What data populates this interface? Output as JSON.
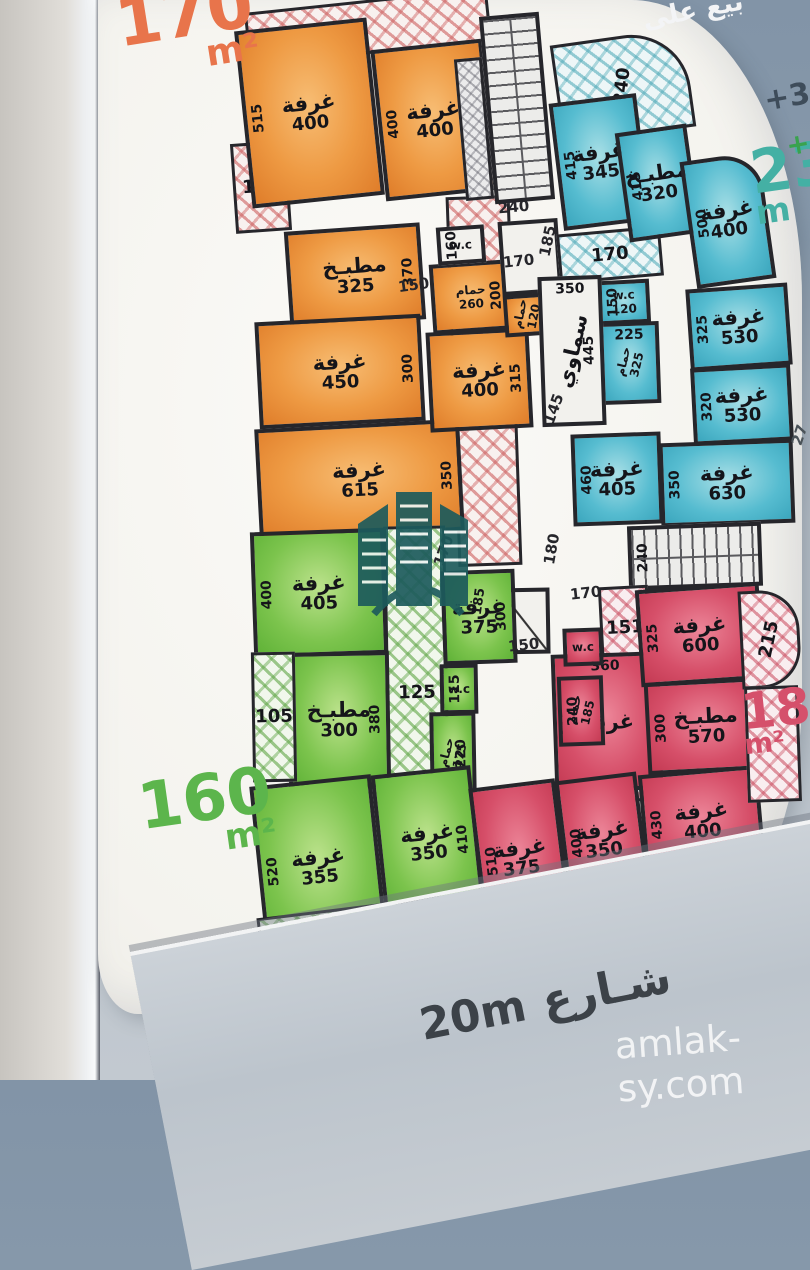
{
  "photo": {
    "captions": {
      "top_right_partial": "بيع على",
      "street": "شـارع 20m",
      "watermark": "amlak-sy.com"
    },
    "area_tags": {
      "unit_170": {
        "value": "170",
        "unit": "m²"
      },
      "unit_230": {
        "value": "230",
        "unit": "m"
      },
      "unit_160": {
        "value": "160",
        "unit": "m²"
      },
      "unit_185": {
        "value": "185",
        "unit": "m²"
      },
      "floor_35": "+35",
      "floor_3": "+3",
      "edge_partial": "27"
    },
    "colors": {
      "orange_unit": "#ee9a43",
      "cyan_unit": "#56bcd0",
      "green_unit": "#7cc44d",
      "red_unit": "#d64f69",
      "walls": "#26262b",
      "logo": "#1d5b5c"
    }
  },
  "plan": {
    "rooms": [
      {
        "name": "balcony-hatched",
        "fill": "h-pink",
        "hatch": true,
        "rect": [
          246,
          0,
          244,
          54
        ],
        "rot": -6
      },
      {
        "name": "balcony-hatched",
        "fill": "h-pink",
        "hatch": true,
        "value": "125",
        "rect": [
          233,
          142,
          56,
          90
        ],
        "rot": -4
      },
      {
        "name": "corridor-hatched",
        "fill": "h-pink",
        "hatch": true,
        "rect": [
          452,
          196,
          64,
          370
        ],
        "rot": -2
      },
      {
        "name": "room-bedroom",
        "fill": "orange",
        "label": "غرفة",
        "value": "400",
        "side": "515",
        "side_pos": "left",
        "rect": [
          243,
          24,
          133,
          178
        ],
        "rot": -6
      },
      {
        "name": "room-bedroom",
        "fill": "orange",
        "label": "غرفة",
        "value": "400",
        "side": "400",
        "side_pos": "left",
        "rect": [
          378,
          44,
          112,
          152
        ],
        "rot": -6
      },
      {
        "name": "room-kitchen",
        "fill": "orange",
        "label": "مطبـخ",
        "value": "325",
        "side": "370",
        "side_pos": "right",
        "rect": [
          287,
          227,
          136,
          97
        ],
        "rot": -4
      },
      {
        "name": "room-bedroom",
        "fill": "orange",
        "label": "غرفة",
        "value": "450",
        "side": "300",
        "side_pos": "right",
        "rect": [
          257,
          318,
          166,
          107
        ],
        "rot": -3
      },
      {
        "name": "room-bedroom",
        "fill": "orange",
        "label": "غرفة",
        "value": "615",
        "side": "350",
        "side_pos": "right",
        "rect": [
          257,
          424,
          205,
          112
        ],
        "rot": -3
      },
      {
        "name": "room-bedroom",
        "fill": "orange",
        "label": "غرفة",
        "value": "400",
        "side": "315",
        "side_pos": "right",
        "rect": [
          428,
          330,
          103,
          100
        ],
        "rot": -3
      },
      {
        "name": "room-bath",
        "fill": "orange",
        "small": true,
        "label": "حمام",
        "value": "260",
        "side": "200",
        "side_pos": "right",
        "rect": [
          431,
          262,
          80,
          70
        ],
        "rot": -4
      },
      {
        "name": "room-wc",
        "fill": "white",
        "small": true,
        "label": "w.c",
        "side": "160",
        "side_pos": "left",
        "rect": [
          437,
          226,
          48,
          38
        ],
        "rot": -4
      },
      {
        "name": "stairs",
        "fill": "stairH",
        "rect": [
          487,
          14,
          60,
          188
        ],
        "rot": -5
      },
      {
        "name": "elevator-hatched",
        "fill": "h-gray",
        "hatch": true,
        "rect": [
          460,
          58,
          28,
          142
        ],
        "rot": -5
      },
      {
        "name": "hallway",
        "fill": "white",
        "rect": [
          500,
          220,
          60,
          74
        ],
        "rot": -4
      },
      {
        "name": "room-bath",
        "fill": "orange",
        "small": true,
        "vert": true,
        "label": "حمام",
        "value": "120",
        "rect": [
          504,
          294,
          46,
          42
        ],
        "rot": -4
      },
      {
        "name": "balcony-hatched",
        "fill": "h-cyan",
        "hatch": true,
        "vert": true,
        "value": "240",
        "rect": [
          556,
          36,
          134,
          100
        ],
        "rot": -8,
        "radius": "0 60px 0 0"
      },
      {
        "name": "corridor-hatched",
        "fill": "h-cyan",
        "hatch": true,
        "value": "170",
        "rect": [
          558,
          230,
          104,
          50
        ],
        "rot": -5
      },
      {
        "name": "room-bedroom",
        "fill": "cyan",
        "label": "غرفة",
        "value": "345",
        "side": "415",
        "side_pos": "left",
        "rect": [
          556,
          98,
          88,
          128
        ],
        "rot": -7
      },
      {
        "name": "room-kitchen",
        "fill": "cyan",
        "label": "مطبـخ",
        "value": "320",
        "side": "415",
        "side_pos": "left",
        "rect": [
          622,
          128,
          72,
          110
        ],
        "rot": -8
      },
      {
        "name": "room-bedroom",
        "fill": "cyan",
        "label": "غرفة",
        "value": "400",
        "side": "500",
        "side_pos": "left",
        "rect": [
          688,
          156,
          80,
          128
        ],
        "rot": -8,
        "radius": "0 40px 0 0"
      },
      {
        "name": "room-bedroom",
        "fill": "cyan",
        "label": "غرفة",
        "value": "530",
        "side": "325",
        "side_pos": "left",
        "rect": [
          688,
          286,
          102,
          82
        ],
        "rot": -4
      },
      {
        "name": "room-bedroom",
        "fill": "cyan",
        "label": "غرفة",
        "value": "530",
        "side": "320",
        "side_pos": "left",
        "rect": [
          692,
          366,
          100,
          77
        ],
        "rot": -3
      },
      {
        "name": "room-bedroom",
        "fill": "cyan",
        "label": "غرفة",
        "value": "630",
        "side": "350",
        "side_pos": "left",
        "rect": [
          660,
          441,
          134,
          84
        ],
        "rot": -2
      },
      {
        "name": "room-bedroom",
        "fill": "cyan",
        "label": "غرفة",
        "value": "405",
        "side": "460",
        "side_pos": "left",
        "rect": [
          572,
          433,
          90,
          92
        ],
        "rot": -2
      },
      {
        "name": "room-wc",
        "fill": "cyan",
        "small": true,
        "label": "w.c",
        "value": "120",
        "side": "150",
        "side_pos": "left",
        "rect": [
          598,
          280,
          52,
          44
        ],
        "rot": -3
      },
      {
        "name": "room-bath",
        "fill": "cyan",
        "small": true,
        "vert": true,
        "label": "حمام",
        "value": "325",
        "top": "225",
        "rect": [
          600,
          322,
          60,
          82
        ],
        "rot": -2
      },
      {
        "name": "skylight",
        "fill": "white",
        "vert": true,
        "label": "سماوي",
        "side": "445",
        "side_pos": "right",
        "top": "350",
        "rect": [
          540,
          276,
          64,
          150
        ],
        "rot": -2
      },
      {
        "name": "stairs",
        "fill": "stairV",
        "side": "240",
        "side_pos": "left",
        "rect": [
          628,
          524,
          134,
          64
        ],
        "rot": -2
      },
      {
        "name": "hall-door",
        "fill": "door",
        "rect": [
          498,
          588,
          52,
          66
        ],
        "rot": -1
      },
      {
        "name": "corridor-hatched",
        "fill": "h-green",
        "hatch": true,
        "value": "125",
        "rect": [
          386,
          526,
          62,
          334
        ],
        "rot": -1
      },
      {
        "name": "room-bedroom",
        "fill": "green",
        "label": "غرفة",
        "value": "405",
        "side": "400",
        "side_pos": "left",
        "rect": [
          252,
          530,
          134,
          126
        ],
        "rot": -2
      },
      {
        "name": "room-bedroom",
        "fill": "green",
        "label": "غرفة",
        "value": "375",
        "side": "300",
        "side_pos": "right",
        "side2": "185",
        "rect": [
          442,
          570,
          74,
          94
        ],
        "rot": -2
      },
      {
        "name": "room-kitchen",
        "fill": "green",
        "label": "مطبـخ",
        "value": "300",
        "side": "380",
        "side_pos": "right",
        "rect": [
          288,
          652,
          102,
          136
        ],
        "rot": -1
      },
      {
        "name": "room-wc",
        "fill": "green",
        "small": true,
        "label": "w.c",
        "side": "115",
        "side_pos": "left",
        "rect": [
          440,
          664,
          38,
          50
        ],
        "rot": -1
      },
      {
        "name": "room-bath",
        "fill": "green",
        "small": true,
        "vert": true,
        "label": "حمام",
        "value": "175",
        "side": "220",
        "side_pos": "right",
        "rect": [
          430,
          712,
          46,
          84
        ],
        "rot": -1
      },
      {
        "name": "balcony-hatched",
        "fill": "h-green",
        "hatch": true,
        "value": "105",
        "rect": [
          252,
          652,
          44,
          130
        ],
        "rot": -1
      },
      {
        "name": "room-bedroom",
        "fill": "green",
        "label": "غرفة",
        "value": "355",
        "side": "520",
        "side_pos": "left",
        "rect": [
          258,
          780,
          122,
          174
        ],
        "rot": -6
      },
      {
        "name": "room-bedroom",
        "fill": "green",
        "label": "غرفة",
        "value": "350",
        "side": "410",
        "side_pos": "right",
        "rect": [
          378,
          770,
          100,
          146
        ],
        "rot": -6
      },
      {
        "name": "balcony-hatched",
        "fill": "h-green",
        "hatch": true,
        "vert": true,
        "value": "226",
        "rect": [
          262,
          902,
          262,
          108
        ],
        "rot": -7,
        "radius": "0 0 30px 90px"
      },
      {
        "name": "corridor-hatched",
        "fill": "h-red",
        "hatch": true,
        "value": "151",
        "rect": [
          600,
          586,
          50,
          84
        ],
        "rot": -3
      },
      {
        "name": "corridor-hatched",
        "fill": "h-red",
        "hatch": true,
        "vert": true,
        "value": "205",
        "rect": [
          586,
          740,
          58,
          62
        ],
        "rot": -2
      },
      {
        "name": "room-bedroom",
        "fill": "red",
        "label": "غرفة",
        "side": "415",
        "side_pos": "left",
        "top": "360",
        "rect": [
          553,
          653,
          108,
          138
        ],
        "rot": -2
      },
      {
        "name": "room-bedroom",
        "fill": "red",
        "label": "غرفة",
        "value": "600",
        "side": "325",
        "side_pos": "left",
        "rect": [
          638,
          586,
          124,
          97
        ],
        "rot": -4
      },
      {
        "name": "room-kitchen",
        "fill": "red",
        "label": "مطبـخ",
        "value": "570",
        "side": "300",
        "side_pos": "left",
        "rect": [
          646,
          680,
          120,
          92
        ],
        "rot": -3
      },
      {
        "name": "room-bedroom",
        "fill": "red",
        "label": "غرفة",
        "value": "400",
        "side": "430",
        "side_pos": "left",
        "rect": [
          642,
          770,
          120,
          102
        ],
        "rot": -5
      },
      {
        "name": "room-bedroom",
        "fill": "red",
        "label": "غرفة",
        "value": "375",
        "side": "510",
        "side_pos": "left",
        "rect": [
          477,
          783,
          87,
          150
        ],
        "rot": -7
      },
      {
        "name": "room-bedroom",
        "fill": "red",
        "label": "غرفة",
        "value": "350",
        "side": "400",
        "side_pos": "left",
        "rect": [
          562,
          776,
          82,
          128
        ],
        "rot": -7
      },
      {
        "name": "room-bath",
        "fill": "red",
        "small": true,
        "vert": true,
        "label": "حمام",
        "value": "185",
        "side": "240",
        "side_pos": "left",
        "rect": [
          558,
          676,
          46,
          70
        ],
        "rot": -2
      },
      {
        "name": "room-wc",
        "fill": "red",
        "small": true,
        "label": "w.c",
        "rect": [
          563,
          628,
          40,
          38
        ],
        "rot": -2
      },
      {
        "name": "balcony-hatched",
        "fill": "h-red",
        "hatch": true,
        "vert": true,
        "value": "215",
        "rect": [
          740,
          590,
          60,
          98
        ],
        "rot": -3,
        "radius": "0 40px 40px 0"
      },
      {
        "name": "balcony-hatched",
        "fill": "h-red",
        "hatch": true,
        "rect": [
          746,
          686,
          54,
          116
        ],
        "rot": -2
      },
      {
        "name": "balcony-hatched",
        "fill": "h-red",
        "hatch": true,
        "vert": true,
        "value": "206",
        "rect": [
          620,
          860,
          140,
          142
        ],
        "rot": -5,
        "radius": "0 0 60px 20px"
      }
    ],
    "labels": [
      {
        "t": "240",
        "x": 498,
        "y": 198,
        "rot": -5
      },
      {
        "t": "150",
        "x": 398,
        "y": 276,
        "rot": -8
      },
      {
        "t": "170",
        "x": 503,
        "y": 252,
        "rot": -6
      },
      {
        "t": "185",
        "x": 532,
        "y": 232,
        "rot": -78
      },
      {
        "t": "145",
        "x": 538,
        "y": 400,
        "rot": -70
      },
      {
        "t": "170",
        "x": 428,
        "y": 542,
        "rot": -70
      },
      {
        "t": "180",
        "x": 536,
        "y": 540,
        "rot": -80
      },
      {
        "t": "170",
        "x": 570,
        "y": 584,
        "rot": -6
      },
      {
        "t": "150",
        "x": 508,
        "y": 636,
        "rot": -6
      },
      {
        "t": "27",
        "x": 789,
        "y": 426,
        "rot": -72,
        "color": "#4a5258"
      }
    ]
  }
}
